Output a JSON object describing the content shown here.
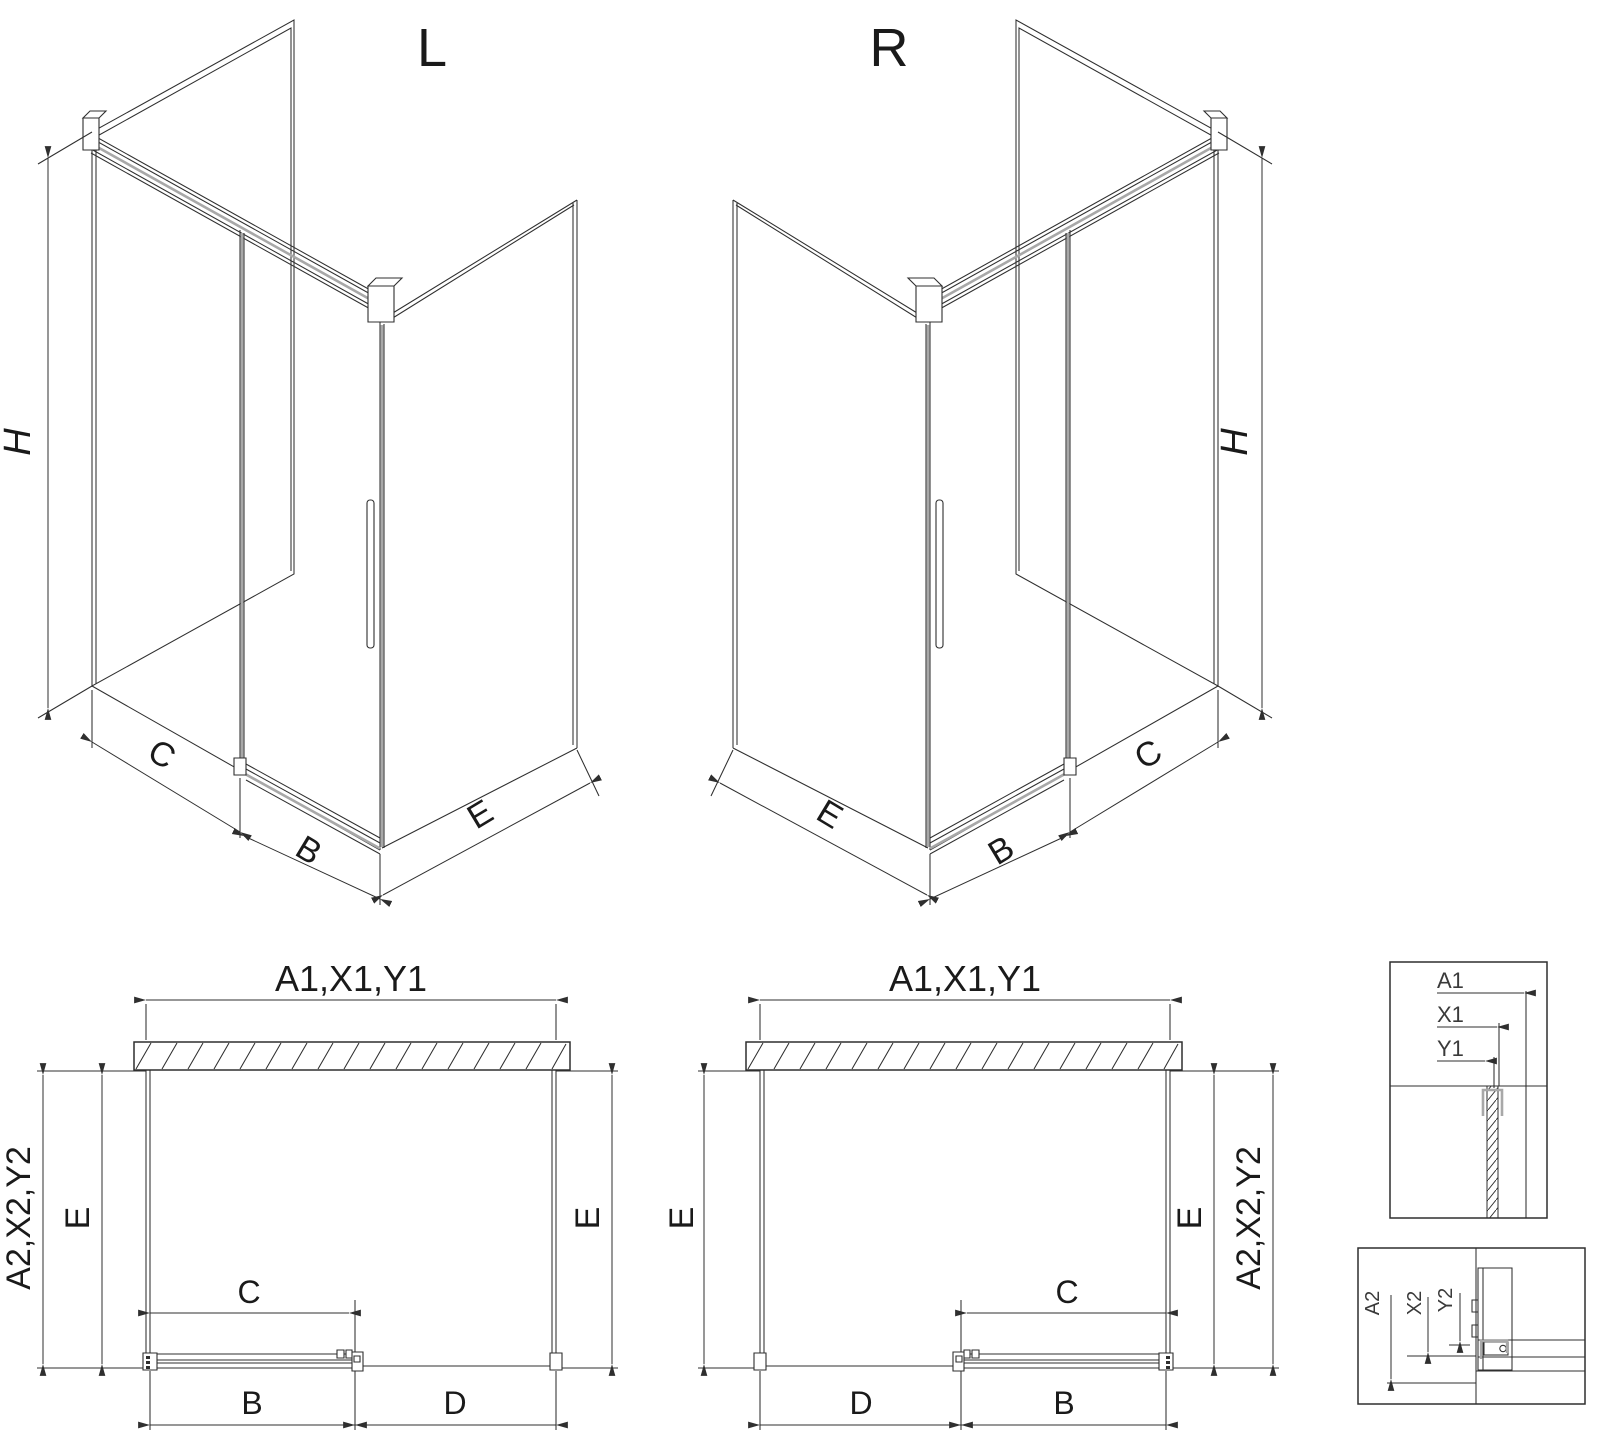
{
  "drawing": {
    "background": "#ffffff",
    "line_color": "#2f2f2f",
    "accent_grey": "#a8a8a8",
    "views": {
      "iso_left": {
        "title": "L",
        "h": "H",
        "c": "C",
        "b": "B",
        "e": "E"
      },
      "iso_right": {
        "title": "R",
        "h": "H",
        "c": "C",
        "b": "B",
        "e": "E"
      },
      "plan_left": {
        "top": "A1,X1,Y1",
        "left_outer": "A2,X2,Y2",
        "left_inner": "E",
        "right": "E",
        "c": "C",
        "b": "B",
        "d": "D"
      },
      "plan_right": {
        "top": "A1,X1,Y1",
        "left": "E",
        "c": "C",
        "d": "D",
        "b": "B",
        "right_inner": "E",
        "right_outer": "A2,X2,Y2"
      },
      "detail_top": {
        "a1": "A1",
        "x1": "X1",
        "y1": "Y1"
      },
      "detail_bottom": {
        "a2": "A2",
        "x2": "X2",
        "y2": "Y2"
      }
    }
  }
}
